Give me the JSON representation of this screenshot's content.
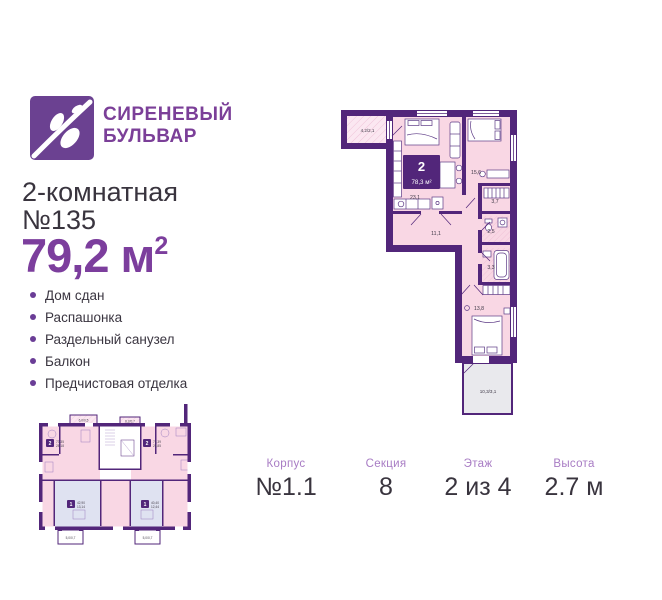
{
  "brand": {
    "line1": "СИРЕНЕВЫЙ",
    "line2": "БУЛЬВАР"
  },
  "listing": {
    "title_line1": "2-комнатная",
    "title_line2": "№135",
    "area_value": "79,2 м",
    "area_sup": "2"
  },
  "features": [
    "Дом сдан",
    "Распашонка",
    "Раздельный санузел",
    "Балкон",
    "Предчистовая отделка"
  ],
  "floorplan": {
    "badge": {
      "rooms": "2",
      "area": "78,3 м²"
    },
    "labels": {
      "balcony": "4,2/2,1",
      "living": "23,1",
      "bedroom1": "15,6",
      "closet": "3,7",
      "hall": "11,1",
      "wc": "2,5",
      "bath": "3,3",
      "bedroom2": "13,8",
      "terrace": "10,3/3,1"
    }
  },
  "miniplan": {
    "badge_left": {
      "rooms": "2",
      "total": "73,35",
      "living": "28,18"
    },
    "badge_right": {
      "rooms": "2",
      "total": "71,39",
      "living": "29,85"
    },
    "badge_bottom_left": {
      "rooms": "1",
      "total": "42,90",
      "living": "13,14"
    },
    "badge_bottom_right": {
      "rooms": "1",
      "total": "40,40",
      "living": "12,44"
    },
    "balcony_top_left": "6,0/0,5",
    "balcony_top_right": "6,2/0,7",
    "balcony_bottom_left": "5,0/0,7",
    "balcony_bottom_right": "5,0/0,7"
  },
  "details": [
    {
      "label": "Корпус",
      "value": "№1.1"
    },
    {
      "label": "Секция",
      "value": "8"
    },
    {
      "label": "Этаж",
      "value": "2 из 4"
    },
    {
      "label": "Высота",
      "value": "2.7 м"
    }
  ],
  "colors": {
    "wall_purple": "#52267a",
    "brand_purple": "#6b4191",
    "accent_purple": "#7c3e9d",
    "room_pink": "#f9d7e4",
    "room_blue": "#dfe2f1",
    "terrace_gray": "#e9e9ed",
    "label_lilac": "#a87cc4",
    "text_dark": "#39343e"
  }
}
